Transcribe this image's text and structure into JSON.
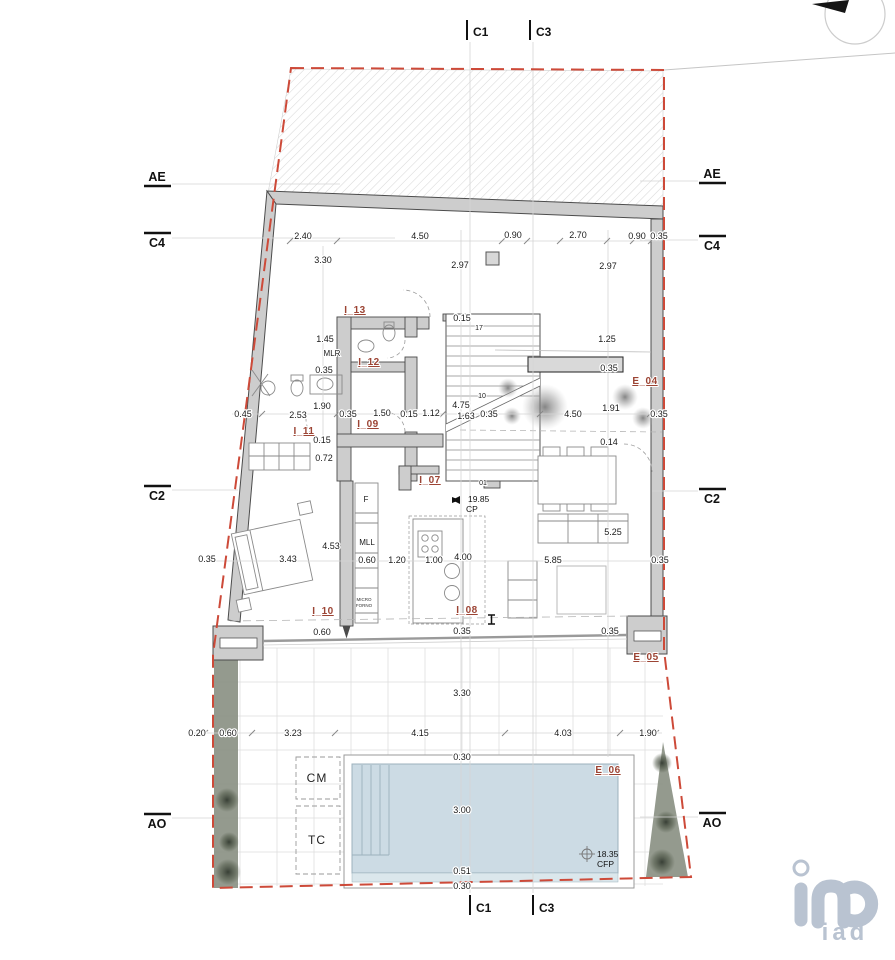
{
  "title": "architectural floor plan",
  "colors": {
    "boundary_red": "#cd4a39",
    "room_label_accent": "#9c4434",
    "wall_fill": "#cdcdcd",
    "pool_water": "#ccdbe4",
    "planting_olive": "#8b9184",
    "logo_gray_blue": "#b9c3d1"
  },
  "markers": {
    "c1": "C1",
    "c3": "C3",
    "ae": "AE",
    "c4": "C4",
    "c2": "C2",
    "ao": "AO"
  },
  "rooms": {
    "i07": "I_07",
    "i08": "I_08",
    "i09": "I_09",
    "i10": "I_10",
    "i11": "I_11",
    "i12": "I_12",
    "i13": "I_13",
    "e04": "E_04",
    "e05": "E_05",
    "e06": "E_06"
  },
  "labels": {
    "mlr": "MLR",
    "mll": "MLL",
    "f": "F",
    "micro": "MICRO",
    "forno": "FORNO",
    "cm": "CM",
    "tc": "TC"
  },
  "levels": {
    "cp_value": "19.85",
    "cp": "CP",
    "cfp_value": "18.35",
    "cfp": "CFP"
  },
  "stairs": {
    "n17": "17",
    "n10": "10",
    "n01": "01"
  },
  "dims": {
    "top": [
      "2.40",
      "4.50",
      "0.90",
      "2.70",
      "0.90",
      "0.35"
    ],
    "upper": [
      "3.30",
      "2.97",
      "2.97"
    ],
    "mid": [
      "0.45",
      "2.53",
      "0.35",
      "1.50",
      "0.15",
      "1.12",
      "1.63",
      "0.35",
      "4.50",
      "1.91",
      "0.35"
    ],
    "bath": [
      "1.45",
      "0.35",
      "1.90",
      "0.15",
      "0.72"
    ],
    "stair": [
      "0.15",
      "4.75"
    ],
    "terrace": [
      "1.25",
      "0.35",
      "0.14"
    ],
    "kitchen": [
      "0.60",
      "1.20",
      "1.00",
      "4.00"
    ],
    "living": [
      "5.25",
      "5.85",
      "0.35",
      "4.53",
      "3.43",
      "0.35"
    ],
    "glass": [
      "0.60",
      "0.35",
      "0.35"
    ],
    "patio": [
      "0.20",
      "0.60",
      "3.23",
      "4.15",
      "4.03",
      "1.90"
    ],
    "pool": [
      "3.30",
      "0.30",
      "3.00",
      "0.51",
      "0.30"
    ]
  },
  "logo": {
    "brand": "iad"
  }
}
